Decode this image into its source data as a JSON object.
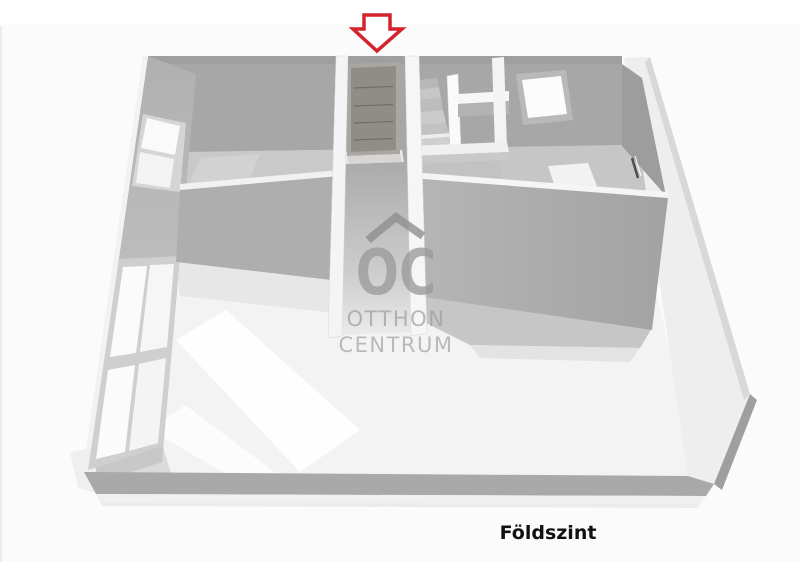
{
  "floor_label": "Földszint",
  "watermark": {
    "logo_text": "OC",
    "brand_line1": "OTTHON",
    "brand_line2": "CENTRUM",
    "color": "#9b9b9b"
  },
  "entrance_arrow": {
    "direction": "down",
    "stroke_color": "#d2232e",
    "fill_color": "#ffffff"
  },
  "palette": {
    "background": "#fbfbfb",
    "wall_shadow": "#a7a7a7",
    "wall_light": "#f3f3f3",
    "floor_gray": "#c8c8c8",
    "floor_bright": "#fafafa",
    "label_color": "#111111"
  }
}
